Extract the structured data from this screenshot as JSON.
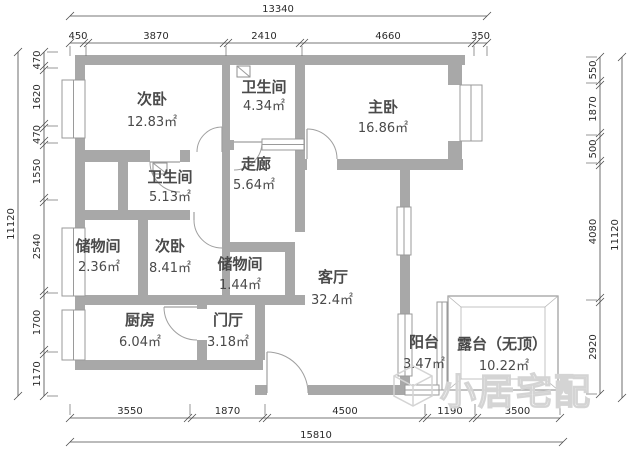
{
  "plan": {
    "rooms": [
      {
        "name": "次卧",
        "area": "12.83㎡"
      },
      {
        "name": "卫生间",
        "area": "4.34㎡"
      },
      {
        "name": "主卧",
        "area": "16.86㎡"
      },
      {
        "name": "卫生间",
        "area": "5.13㎡"
      },
      {
        "name": "走廊",
        "area": "5.64㎡"
      },
      {
        "name": "储物间",
        "area": "2.36㎡"
      },
      {
        "name": "次卧",
        "area": "8.41㎡"
      },
      {
        "name": "储物间",
        "area": "1.44㎡"
      },
      {
        "name": "客厅",
        "area": "32.4㎡"
      },
      {
        "name": "厨房",
        "area": "6.04㎡"
      },
      {
        "name": "门厅",
        "area": "3.18㎡"
      },
      {
        "name": "阳台",
        "area": "3.47㎡"
      },
      {
        "name": "露台（无顶）",
        "area": "10.22㎡"
      }
    ],
    "dimensions": {
      "top": {
        "total": "13340",
        "segments": [
          "450",
          "3870",
          "2410",
          "4660",
          "350"
        ]
      },
      "bottom": {
        "total": "15810",
        "segments": [
          "3550",
          "1870",
          "4500",
          "1190",
          "3500"
        ]
      },
      "left": {
        "total": "11120",
        "segments": [
          "470",
          "1620",
          "470",
          "1550",
          "2540",
          "1700",
          "1170"
        ]
      },
      "right": {
        "total": "11120",
        "segments": [
          "550",
          "1870",
          "500",
          "4080",
          "2920"
        ]
      }
    },
    "watermark": {
      "text": "小居宅配"
    }
  }
}
